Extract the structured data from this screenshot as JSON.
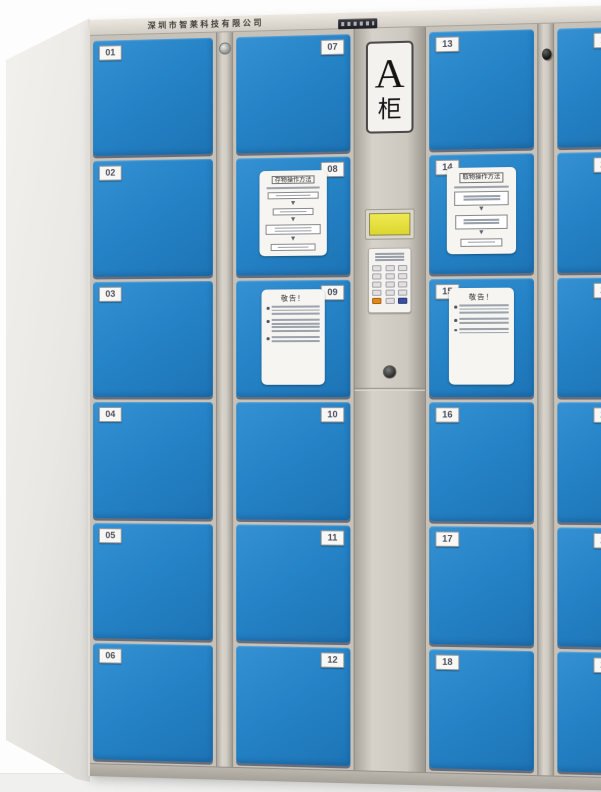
{
  "cabinet": {
    "company_name": "深圳市智莱科技有限公司",
    "sign": {
      "letter": "A",
      "word": "柜"
    },
    "stickers": {
      "deposit_title": "存物操作方法",
      "retrieve_title": "取物操作方法",
      "notice_title": "敬告！"
    },
    "columns": [
      {
        "doors": [
          "01",
          "02",
          "03",
          "04",
          "05",
          "06"
        ]
      },
      {
        "doors": [
          "07",
          "08",
          "09",
          "10",
          "11",
          "12"
        ]
      },
      {
        "doors": [
          "13",
          "14",
          "15",
          "16",
          "17",
          "18"
        ]
      },
      {
        "doors": [
          "19",
          "20",
          "21",
          "22",
          "23",
          "24"
        ]
      }
    ],
    "colors": {
      "door_blue": "#2583C7",
      "frame_beige": "#C9C5BD",
      "lcd_yellow": "#E8E44A",
      "key_orange": "#E0881A",
      "key_blue": "#3A4FA0"
    }
  }
}
